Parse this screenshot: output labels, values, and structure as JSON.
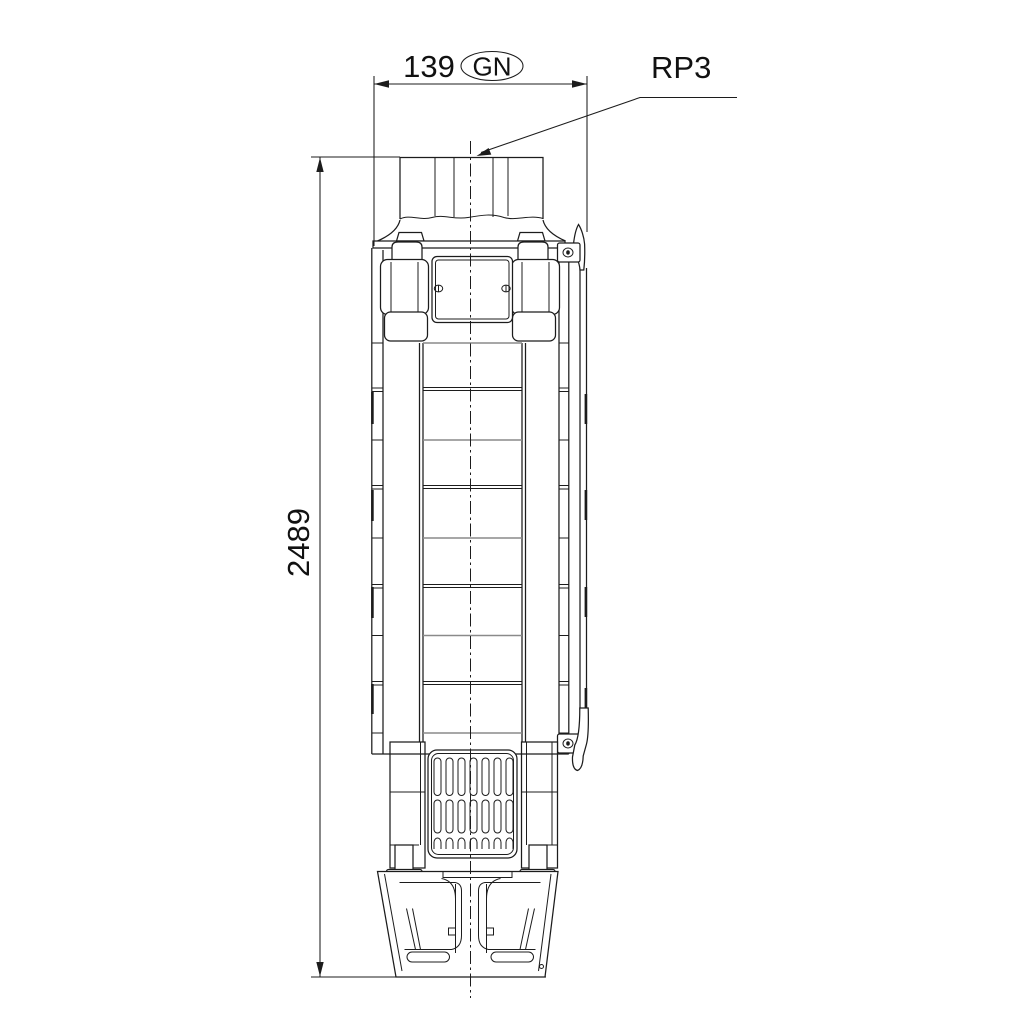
{
  "drawing": {
    "labels": {
      "width_value": "139",
      "thread_code": "GN",
      "connection_size": "RP3",
      "height_value": "2489"
    },
    "colors": {
      "line": "#1c1c1c",
      "secondary_line": "#8a8a8a",
      "background": "#ffffff",
      "text": "#111111"
    }
  }
}
